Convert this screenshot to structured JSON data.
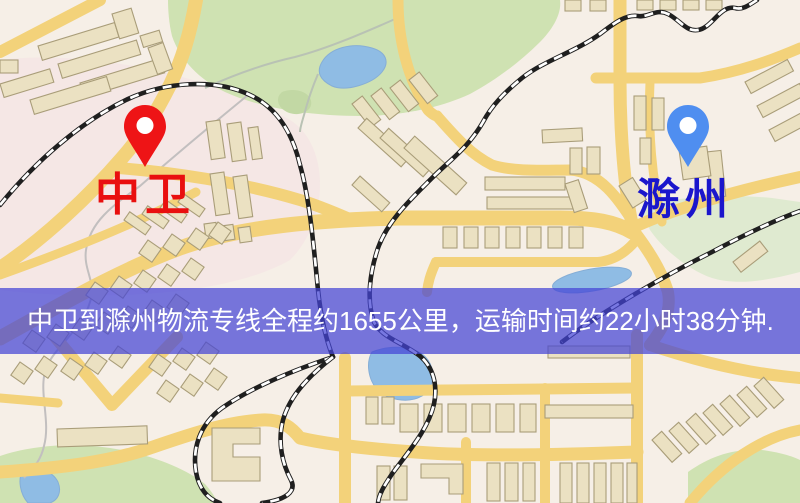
{
  "banner": {
    "text": "中卫到滁州物流专线全程约1655公里，运输时间约22小时38分钟."
  },
  "markers": {
    "origin": {
      "label": "中卫",
      "pin_icon": "map-pin",
      "pin_color": "#ee1416"
    },
    "destination": {
      "label": "滁州",
      "pin_icon": "map-pin",
      "pin_color": "#4f8ef0"
    }
  },
  "colors": {
    "banner_bg": "rgba(68,68,214,0.72)",
    "banner_text": "#ffffff",
    "origin_pin": "#ee1416",
    "origin_label": "#e90f0f",
    "destination_pin": "#4f8ef0",
    "destination_label": "#1b16cc",
    "road": "#f3d27a",
    "park": "#cfe2b2",
    "park_light": "#dfead0",
    "water": "#8fbce4",
    "building_fill": "#ebe1c2",
    "building_stroke": "#a99d79",
    "railway": "#1f1f1f",
    "map_bg": "#f6efe7"
  }
}
